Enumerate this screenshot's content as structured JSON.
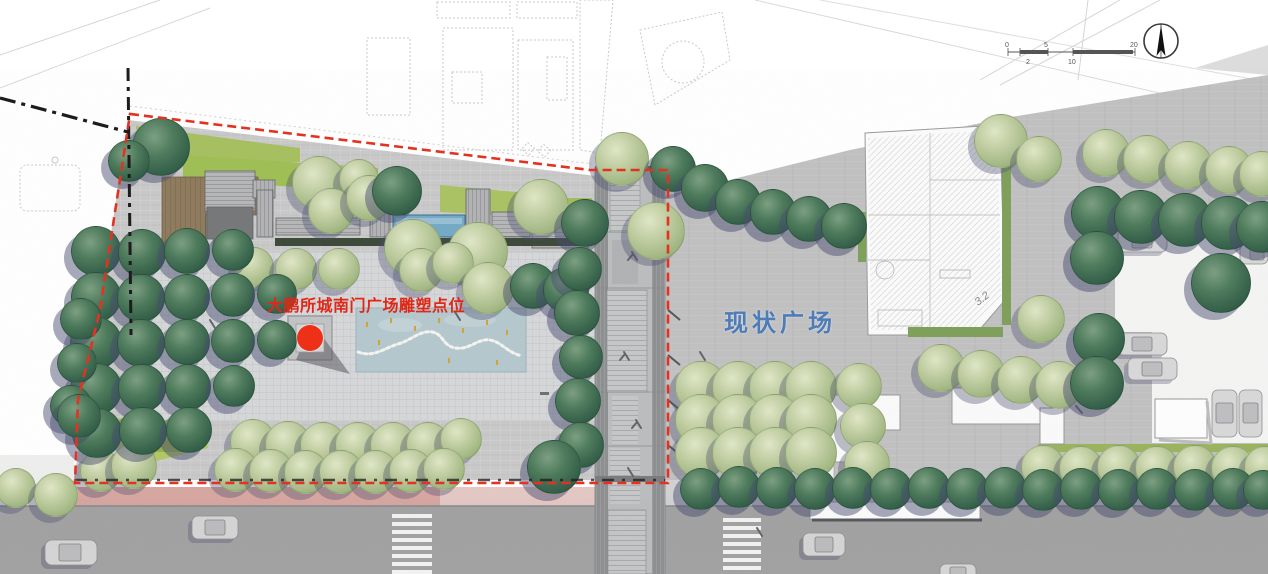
{
  "labels": {
    "sculpture_point": {
      "text": "大鹏所城南门广场雕塑点位",
      "color": "#e02818"
    },
    "existing_plaza": {
      "text": "现状广场",
      "color": "#4d7cb8"
    },
    "building_elevation": {
      "text": "3.2"
    }
  },
  "marker": {
    "name": "sculpture-point",
    "color": "#ee3018",
    "cx": 310,
    "cy": 338,
    "r": 13
  },
  "scale_bar": {
    "ticks": [
      "0",
      "2",
      "5",
      "10",
      "20"
    ]
  },
  "compass": {
    "icon": "north-arrow"
  },
  "boundaries": {
    "site_boundary": {
      "style": "dashed",
      "color": "#e23322"
    },
    "property_line": {
      "style": "dash-dot",
      "color": "#1c1c1c"
    }
  },
  "palette": {
    "water": "#74aac6",
    "water_feature": "#b5c8cd",
    "lawn": "#a6c05f",
    "deck_wood": "#8f7c5e",
    "tree_dark": "#3f6b52",
    "tree_light": "#aec18e",
    "road": "#a2a2a3",
    "bike_lane_pink": "#d7a6a1",
    "plaza_paving": "#c6c6c7"
  }
}
